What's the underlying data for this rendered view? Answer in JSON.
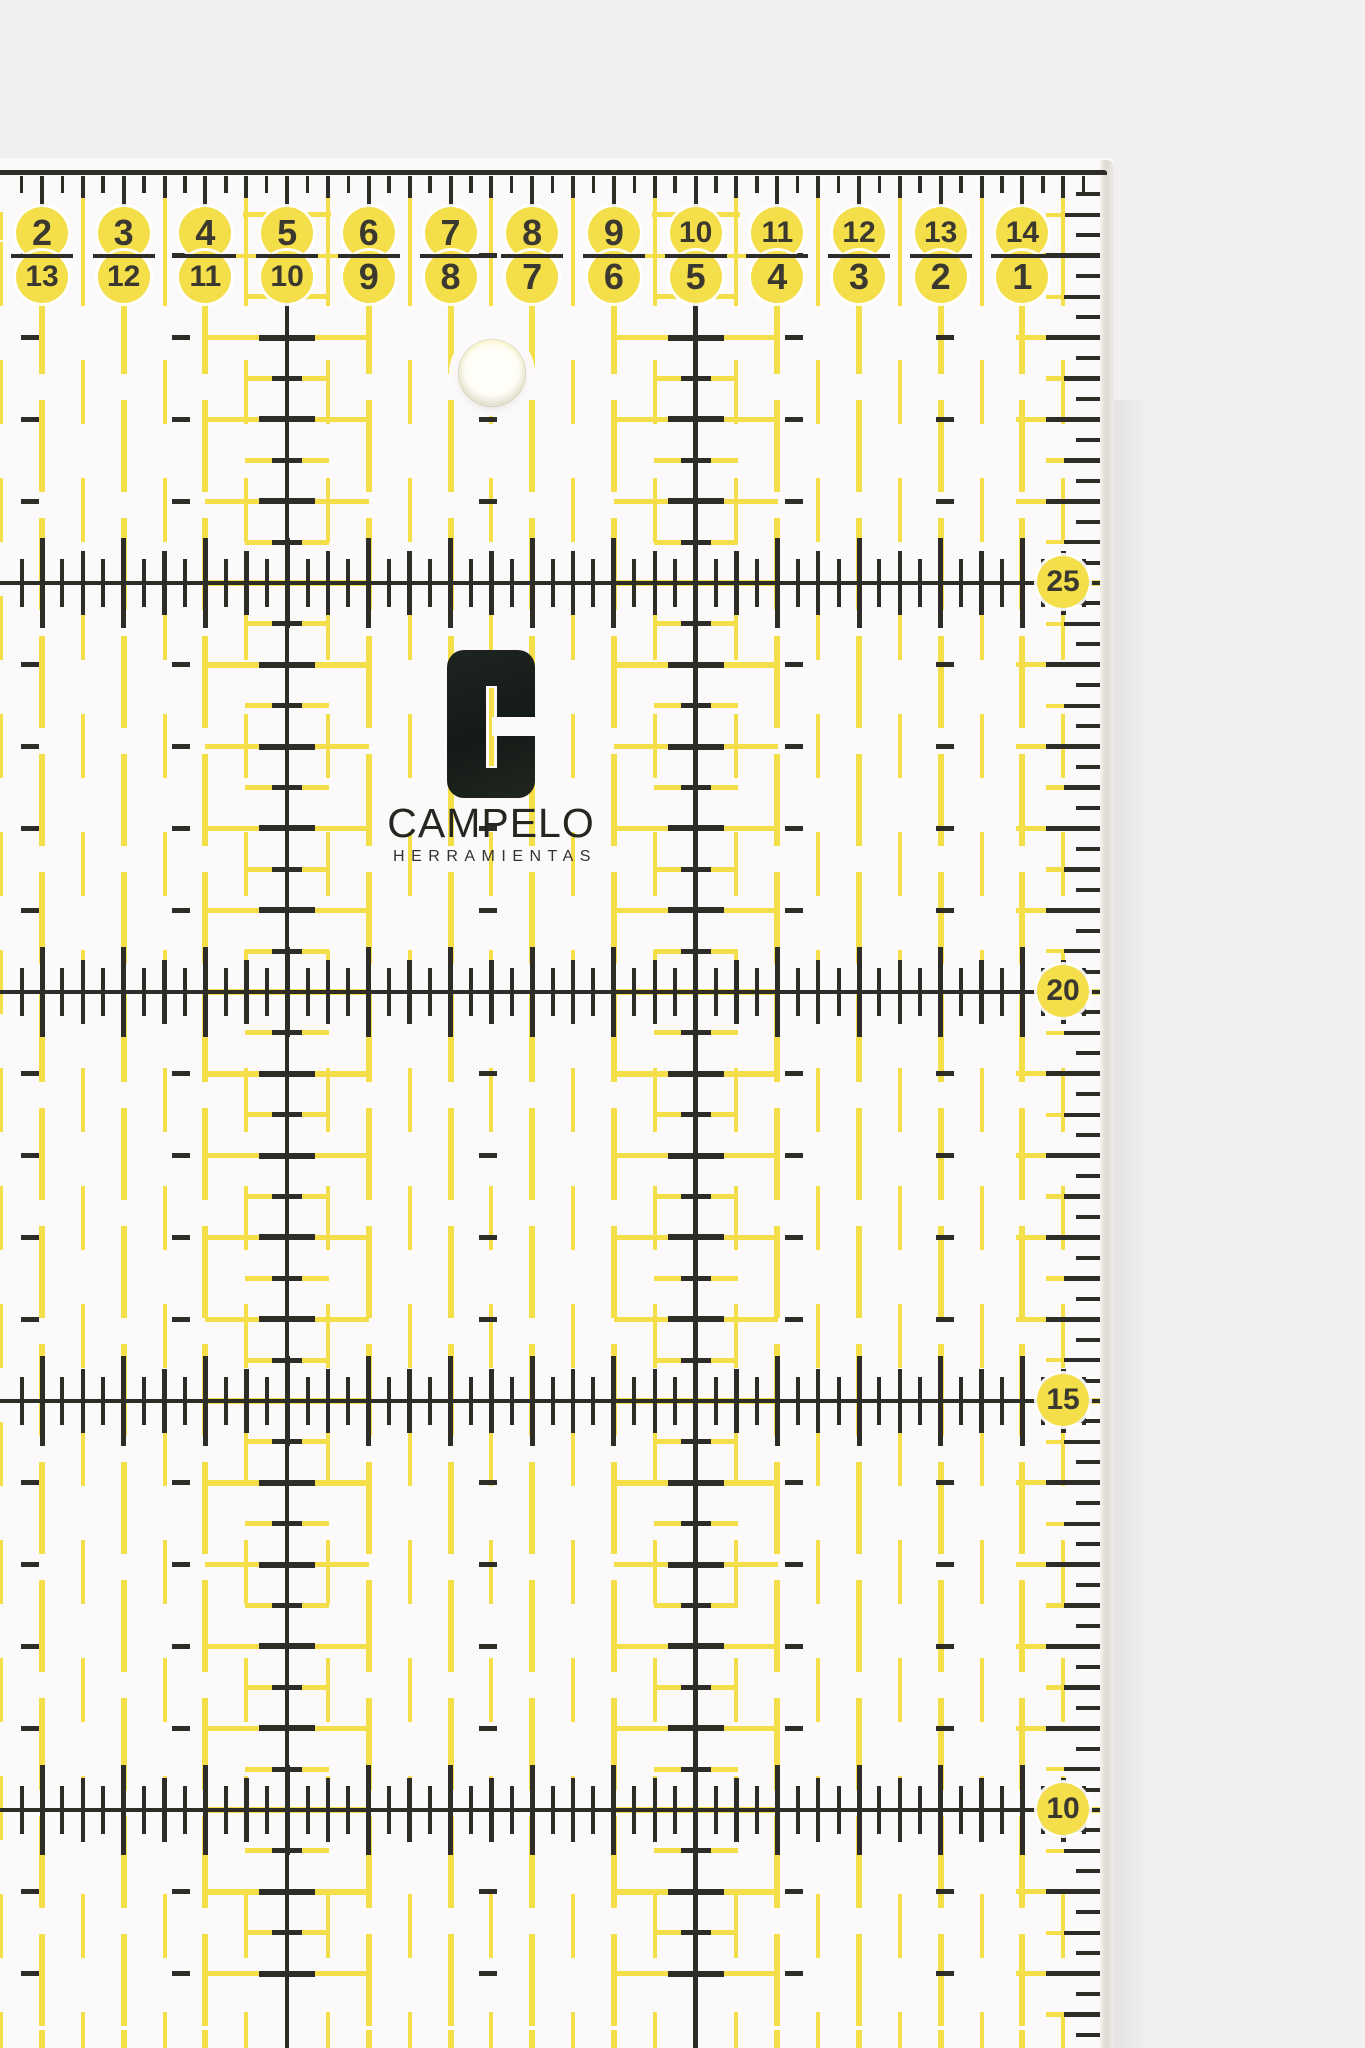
{
  "colors": {
    "background": "#f1eff2",
    "surface": "#fbf9fa",
    "yellow": "#f4de4a",
    "yellow_soft": "#f7e87e",
    "ink": "#2e2c26",
    "number_ink": "#3b392f"
  },
  "top_scale": {
    "primary": [
      "2",
      "3",
      "4",
      "5",
      "6",
      "7",
      "8",
      "9",
      "10",
      "11",
      "12",
      "13",
      "14"
    ],
    "secondary": [
      "13",
      "12",
      "11",
      "10",
      "9",
      "8",
      "7",
      "6",
      "5",
      "4",
      "3",
      "2",
      "1"
    ]
  },
  "right_scale": {
    "labels": [
      "25",
      "20",
      "15",
      "10"
    ]
  },
  "brand": {
    "name": "CAMPELO",
    "tagline": "HERRAMIENTAS"
  }
}
